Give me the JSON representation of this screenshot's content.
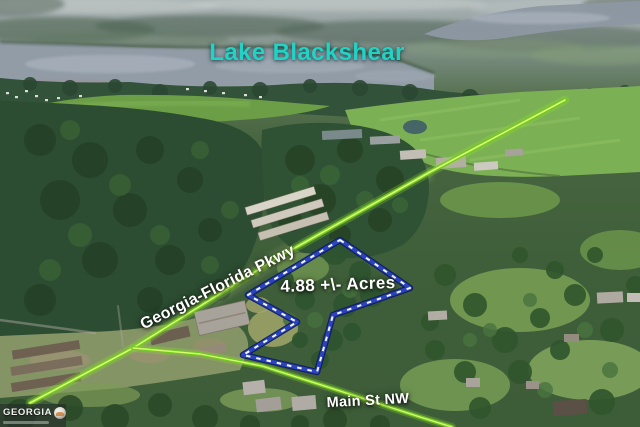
{
  "scene": {
    "labels": {
      "lake": "Lake Blackshear",
      "parkway": "Georgia-Florida Pkwy",
      "acreage": "4.88 +\\- Acres",
      "main_street": "Main St NW"
    },
    "watermark": {
      "brand": "GEORGIA"
    },
    "colors": {
      "lake_label_teal": "#22d3c5",
      "road_highlight_green": "#70ca1f",
      "road_highlight_core": "#e2ff78",
      "parcel_outline_blue": "#2b44bd",
      "parcel_dash_white": "#f3f6ff",
      "street_label_white": "#ffffff"
    }
  }
}
